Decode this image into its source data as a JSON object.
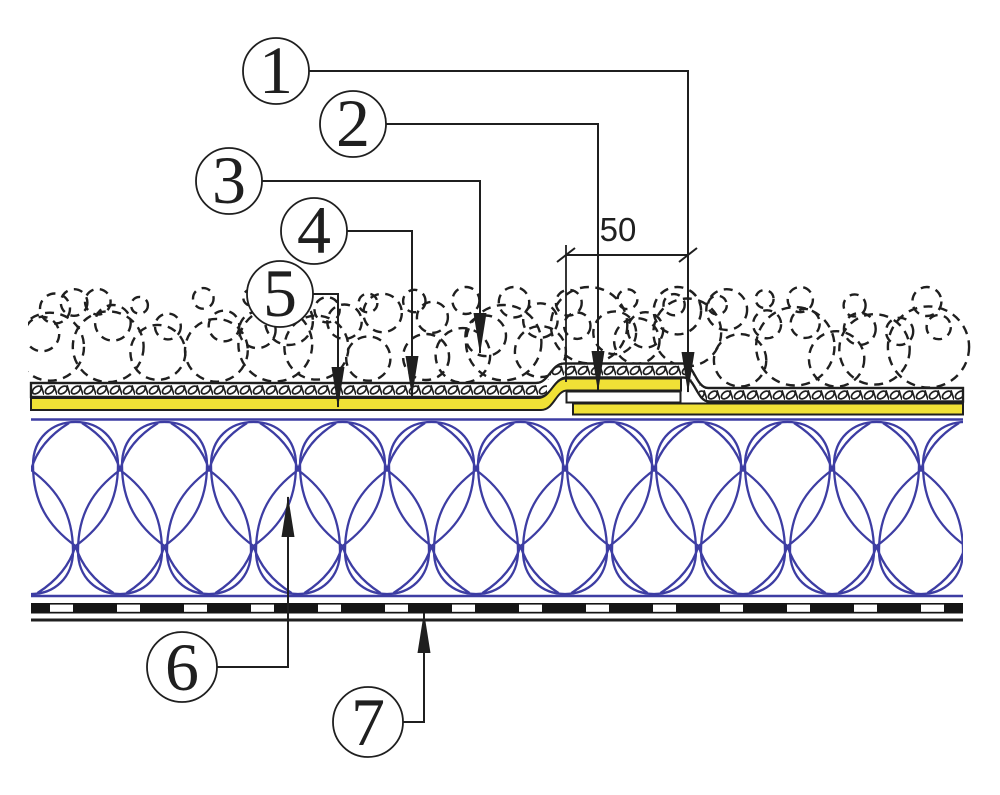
{
  "diagram": {
    "type": "roof-construction-detail-section",
    "dimension": {
      "value": "50"
    },
    "callouts": [
      {
        "label": "1"
      },
      {
        "label": "2"
      },
      {
        "label": "3"
      },
      {
        "label": "4"
      },
      {
        "label": "5"
      },
      {
        "label": "6"
      },
      {
        "label": "7"
      }
    ],
    "colors": {
      "line": "#1f1f1f",
      "membrane_yellow": "#f0e136",
      "insulation_blue": "#3d3da3",
      "barrier_black": "#151515",
      "background": "#ffffff"
    }
  }
}
